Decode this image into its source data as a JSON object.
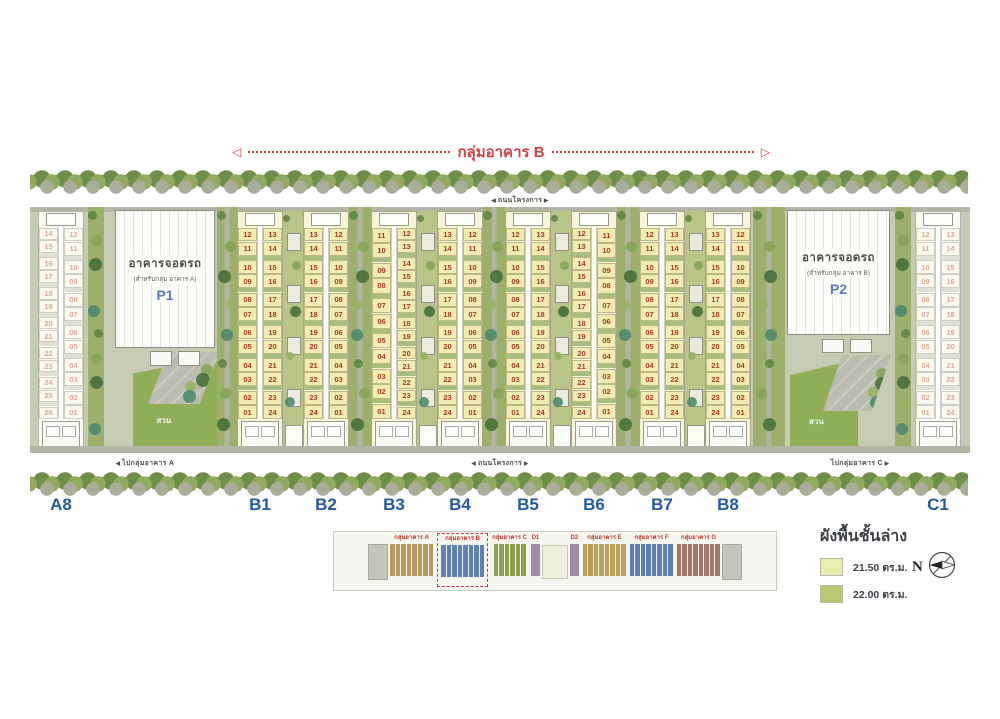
{
  "header": {
    "group_label": "กลุ่มอาคาร B"
  },
  "roads": {
    "project_road_top": "ถนนโครงการ",
    "project_road_bottom": "ถนนโครงการ",
    "to_group_a": "ไปกลุ่มอาคาร A",
    "to_group_c": "ไปกลุ่มอาคาร C"
  },
  "parking": {
    "p1": {
      "title": "อาคารจอดรถ",
      "subtitle": "(สำหรับกลุ่ม อาคาร A)",
      "code": "P1"
    },
    "p2": {
      "title": "อาคารจอดรถ",
      "subtitle": "(สำหรับกลุ่ม อาคาร B)",
      "code": "P2"
    }
  },
  "gardens": {
    "left_label": "สวน",
    "right_label": "สวน"
  },
  "site_labels": [
    "A8",
    "B1",
    "B2",
    "B3",
    "B4",
    "B5",
    "B6",
    "B7",
    "B8",
    "C1"
  ],
  "buildings": {
    "B1": {
      "left": [
        "12",
        "11",
        "10",
        "09",
        "08",
        "07",
        "06",
        "05",
        "04",
        "03",
        "02",
        "01"
      ],
      "right": [
        "13",
        "14",
        "15",
        "16",
        "17",
        "18",
        "19",
        "20",
        "21",
        "22",
        "23",
        "24"
      ]
    },
    "B2": {
      "left": [
        "13",
        "14",
        "15",
        "16",
        "17",
        "18",
        "19",
        "20",
        "21",
        "22",
        "23",
        "24"
      ],
      "right": [
        "12",
        "11",
        "10",
        "09",
        "08",
        "07",
        "06",
        "05",
        "04",
        "03",
        "02",
        "01"
      ]
    },
    "B3": {
      "left": [
        "11",
        "10",
        "09",
        "08",
        "07",
        "06",
        "05",
        "04",
        "03",
        "02",
        "01"
      ],
      "right": [
        "12",
        "13",
        "14",
        "15",
        "16",
        "17",
        "18",
        "19",
        "20",
        "21",
        "22",
        "23",
        "24"
      ]
    },
    "B4": {
      "left": [
        "13",
        "14",
        "15",
        "16",
        "17",
        "18",
        "19",
        "20",
        "21",
        "22",
        "23",
        "24"
      ],
      "right": [
        "12",
        "11",
        "10",
        "09",
        "08",
        "07",
        "06",
        "05",
        "04",
        "03",
        "02",
        "01"
      ]
    },
    "B5": {
      "left": [
        "12",
        "11",
        "10",
        "09",
        "08",
        "07",
        "06",
        "05",
        "04",
        "03",
        "02",
        "01"
      ],
      "right": [
        "13",
        "14",
        "15",
        "16",
        "17",
        "18",
        "19",
        "20",
        "21",
        "22",
        "23",
        "24"
      ]
    },
    "B6": {
      "left": [
        "12",
        "13",
        "14",
        "15",
        "16",
        "17",
        "18",
        "19",
        "20",
        "21",
        "22",
        "23",
        "24"
      ],
      "right": [
        "11",
        "10",
        "09",
        "08",
        "07",
        "06",
        "05",
        "04",
        "03",
        "02",
        "01"
      ]
    },
    "B7": {
      "left": [
        "12",
        "11",
        "10",
        "09",
        "08",
        "07",
        "06",
        "05",
        "04",
        "03",
        "02",
        "01"
      ],
      "right": [
        "13",
        "14",
        "15",
        "16",
        "17",
        "18",
        "19",
        "20",
        "21",
        "22",
        "23",
        "24"
      ]
    },
    "B8": {
      "left": [
        "13",
        "14",
        "15",
        "16",
        "17",
        "18",
        "19",
        "20",
        "21",
        "22",
        "23",
        "24"
      ],
      "right": [
        "12",
        "11",
        "10",
        "09",
        "08",
        "07",
        "06",
        "05",
        "04",
        "03",
        "02",
        "01"
      ]
    },
    "A8": {
      "faded": true,
      "left": [
        "14",
        "15",
        "16",
        "17",
        "18",
        "19",
        "20",
        "21",
        "22",
        "23",
        "24",
        "25",
        "26"
      ],
      "right": [
        "12",
        "11",
        "10",
        "09",
        "08",
        "07",
        "06",
        "05",
        "04",
        "03",
        "02",
        "01"
      ]
    },
    "C1": {
      "faded": true,
      "left": [
        "12",
        "11",
        "10",
        "09",
        "08",
        "07",
        "06",
        "05",
        "04",
        "03",
        "02",
        "01"
      ],
      "right": [
        "13",
        "14",
        "15",
        "16",
        "17",
        "18",
        "19",
        "20",
        "21",
        "22",
        "23",
        "24"
      ]
    }
  },
  "minimap": {
    "groups": [
      {
        "label": "กลุ่มอาคาร A",
        "type": "strips",
        "count": 8,
        "color": "#b89a5f"
      },
      {
        "label": "กลุ่มอาคาร B",
        "type": "strips",
        "count": 8,
        "color": "#5f7fb4",
        "highlight": true
      },
      {
        "label": "กลุ่มอาคาร C",
        "type": "strips",
        "count": 6,
        "color": "#8aa150"
      },
      {
        "label": "D1",
        "type": "block",
        "color": "#a08ca6"
      },
      {
        "label": "",
        "type": "center"
      },
      {
        "label": "D2",
        "type": "block",
        "color": "#a08ca6"
      },
      {
        "label": "กลุ่มอาคาร E",
        "type": "strips",
        "count": 8,
        "color": "#c0a058"
      },
      {
        "label": "กลุ่มอาคาร F",
        "type": "strips",
        "count": 8,
        "color": "#5f7fb4"
      },
      {
        "label": "กลุ่มอาคาร G",
        "type": "strips",
        "count": 8,
        "color": "#a3756b"
      }
    ]
  },
  "legend": {
    "title": "ผังพื้นชั้นล่าง",
    "items": [
      {
        "label": "21.50 ตร.ม.",
        "swatch": "#e9edae"
      },
      {
        "label": "22.00 ตร.ม.",
        "swatch": "#b7c873"
      }
    ],
    "north_label": "N"
  }
}
